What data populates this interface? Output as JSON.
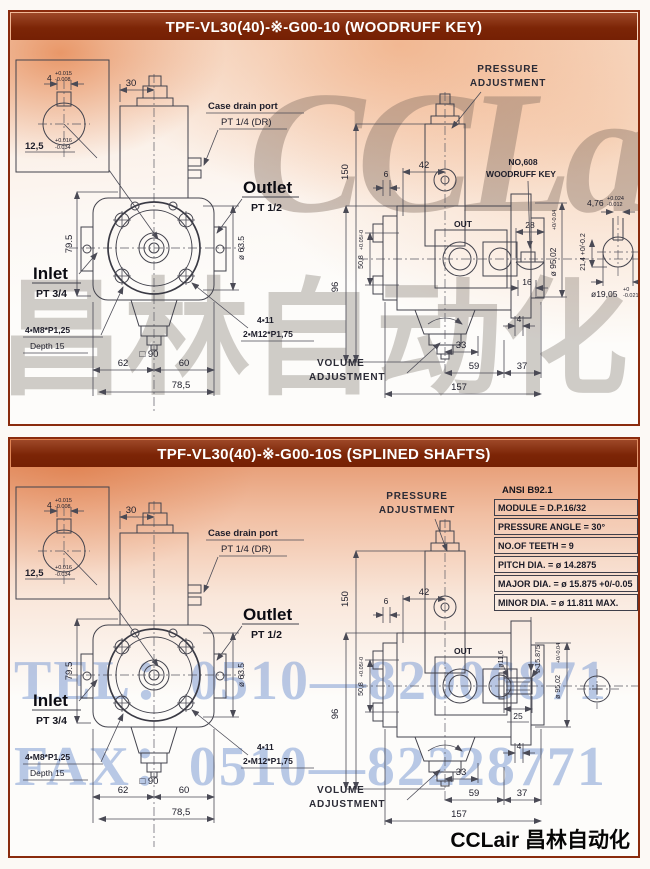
{
  "watermarks": {
    "cclair": "CCLair",
    "chinese": "昌林自动化",
    "tel": "TEL：0510—82006871",
    "fax": "FAX：0510—82228771"
  },
  "footer": {
    "brand": "CCLair 昌林自动化"
  },
  "colors": {
    "title_bar": "#7c2506",
    "panel_border": "#8a2b0d",
    "wash_orange": "#e07a3e",
    "watermark_blue": "#809cd4",
    "line": "#43434d"
  },
  "shared": {
    "labels": {
      "inlet": "Inlet",
      "inlet_pt": "PT 3/4",
      "outlet": "Outlet",
      "outlet_pt": "PT 1/2",
      "case_drain_1": "Case drain port",
      "case_drain_2": "PT 1/4 (DR)",
      "bolts": "4▪M8*P1,25",
      "bolts_depth": "Depth 15",
      "holes": "4▪11",
      "studs": "2▪M12*P1,75",
      "out": "OUT",
      "pressure_1": "PRESSURE",
      "pressure_2": "ADJUSTMENT",
      "volume_1": "VOLUME",
      "volume_2": "ADJUSTMENT"
    },
    "dims": {
      "d30": "30",
      "d79_5": "79.5",
      "d62": "62",
      "d60": "60",
      "d78_5": "78,5",
      "d90": "□ 90",
      "d63_5": "ø 63.5",
      "d150": "150",
      "d96": "96",
      "d42": "42",
      "d6": "6",
      "d50_8": "50,8",
      "d50_8_tol": "+0.05/-0",
      "d95": "ø 95,02",
      "d95_tol": "+0/-0.04",
      "d4": "4",
      "d33": "33",
      "d59": "59",
      "d37": "37",
      "d157": "157",
      "inset_w": "4",
      "inset_w_p": "+0.015",
      "inset_w_m": "-0.008",
      "inset_d": "12,5",
      "inset_d_p": "+0.016",
      "inset_d_m": "-0.034"
    }
  },
  "panels": {
    "p1": {
      "title": "TPF-VL30(40)-※-G00-10 (WOODRUFF KEY)",
      "key_note_1": "NO,608",
      "key_note_2": "WOODRUFF KEY",
      "d28": "28",
      "d16": "16",
      "d4_76": "4,76",
      "d4_76_p": "+0.024",
      "d4_76_m": "-0.012",
      "d21_4": "21,4 +0/-0.2",
      "d19_05": "ø19,05",
      "d19_05_p": "+0",
      "d19_05_m": "-0.021"
    },
    "p2": {
      "title": "TPF-VL30(40)-※-G00-10S (SPLINED SHAFTS)",
      "d11_6": "ø11,6",
      "d15_875": "ø 15.875",
      "d25": "25",
      "table": {
        "header": "ANSI B92.1",
        "rows": [
          "MODULE = D.P.16/32",
          "PRESSURE ANGLE = 30°",
          "NO.OF TEETH = 9",
          "PITCH DIA. = ø 14.2875",
          "MAJOR DIA. = ø 15.875 +0/-0.05",
          "MINOR DIA. = ø 11.811 MAX."
        ]
      }
    }
  }
}
